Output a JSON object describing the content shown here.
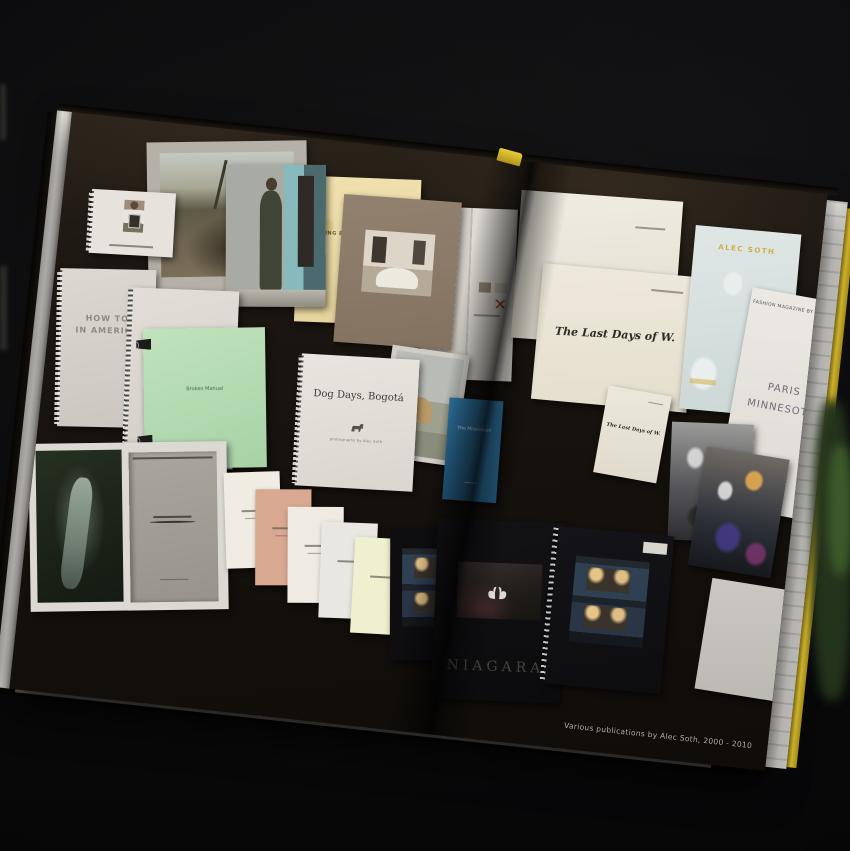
{
  "caption": "Various publications by Alec Soth, 2000 - 2010",
  "publications": {
    "sleeping": {
      "title": "SLEEPING BY THE MISSISSIPPI"
    },
    "how_to": {
      "line1": "HOW TO",
      "line2": "IN AMERICA"
    },
    "broken_manual": {
      "title": "Broken Manual"
    },
    "dog_days": {
      "title": "Dog Days, Bogotá",
      "credit": "photographs by Alec Soth"
    },
    "last_days_front": {
      "title": "The Last Days of W."
    },
    "last_days_small": {
      "title": "The Last Days of W."
    },
    "fashion_magazine": {
      "brand": "ALEC SOTH"
    },
    "paris_minnesota": {
      "header": "FASHION MAGAZINE BY ALEC SOTH",
      "line1": "PARIS",
      "line2": "MINNESOTA"
    },
    "the_mississippi": {
      "title": "The Mississippi"
    },
    "niagara": {
      "title": "NIAGARA"
    }
  },
  "colors": {
    "cover_yellow": "#dcc02e",
    "page_black": "#17120e",
    "backdrop": "#0a0a0c"
  }
}
